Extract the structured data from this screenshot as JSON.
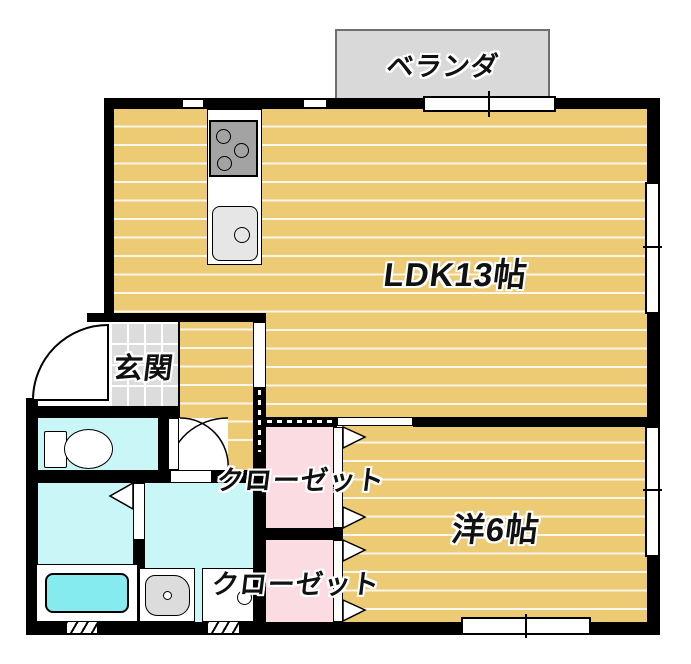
{
  "title": "apartment-floor-plan",
  "rooms": {
    "veranda": {
      "label": "ベランダ"
    },
    "ldk": {
      "label": "LDK13帖"
    },
    "genkan": {
      "label": "玄関"
    },
    "western_room": {
      "label": "洋6帖"
    },
    "closet_upper": {
      "label": "クローゼット"
    },
    "closet_lower": {
      "label": "クローゼット"
    }
  },
  "fixtures": {
    "kitchen_stove": "gas-stove",
    "kitchen_sink": "kitchen-sink",
    "toilet": "toilet",
    "bathtub": "bathtub",
    "washbasin": "washbasin",
    "washer_pan": "washing-machine-pan"
  },
  "colors": {
    "wall": "#000000",
    "floor_wood": "#edca74",
    "closet_pink": "#fbdce2",
    "water_cyan": "#c9f6f6",
    "bathtub_cyan": "#86ebee",
    "veranda_gray": "#d9d9d9",
    "tile_gray": "#dcdcdc",
    "stove_gray": "#a3a3a3",
    "sink_gray": "#e6e6e6"
  }
}
